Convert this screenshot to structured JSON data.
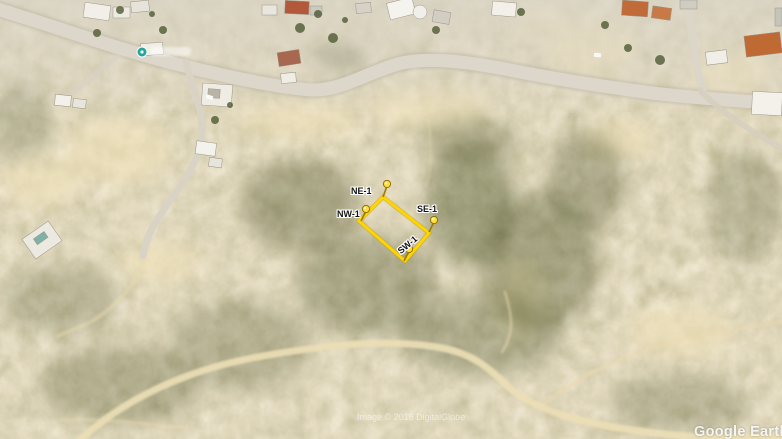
{
  "map": {
    "type": "satellite-imagery",
    "parcel_markers": [
      {
        "id": "ne1",
        "label": "NE-1"
      },
      {
        "id": "nw1",
        "label": "NW-1"
      },
      {
        "id": "se1",
        "label": "SE-1"
      },
      {
        "id": "sw1",
        "label": "SW-1"
      }
    ],
    "parcel_outline_color": "#ffd400",
    "pushpin_color": "#ffdf3d",
    "poi_marker_color": "#1ba39a"
  },
  "watermarks": {
    "imagery_credit": "Image © 2016 DigitalGlobe",
    "logo_text": "Google Earth"
  },
  "icons": {
    "pushpin": "pushpin-icon",
    "poi": "poi-marker-icon"
  }
}
